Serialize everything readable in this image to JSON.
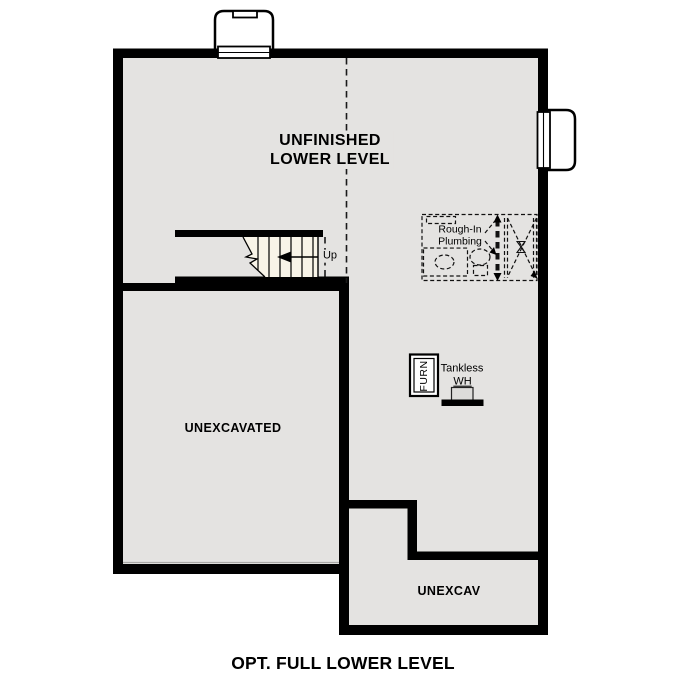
{
  "plan": {
    "caption": "OPT. FULL LOWER LEVEL",
    "rooms": {
      "unfinished": "UNFINISHED\nLOWER LEVEL",
      "unexcavated": "UNEXCAVATED",
      "unexcav": "UNEXCAV"
    },
    "stairs": {
      "direction_label": "Up"
    },
    "plumbing": {
      "note": "Rough-In\nPlumbing"
    },
    "equipment": {
      "furnace_label": "FURN",
      "water_heater_line1": "Tankless",
      "water_heater_line2": "WH"
    },
    "colors": {
      "wall": "#000000",
      "floor": "#e4e3e1",
      "stair_fill": "#f8f4e8",
      "background": "#ffffff"
    }
  }
}
